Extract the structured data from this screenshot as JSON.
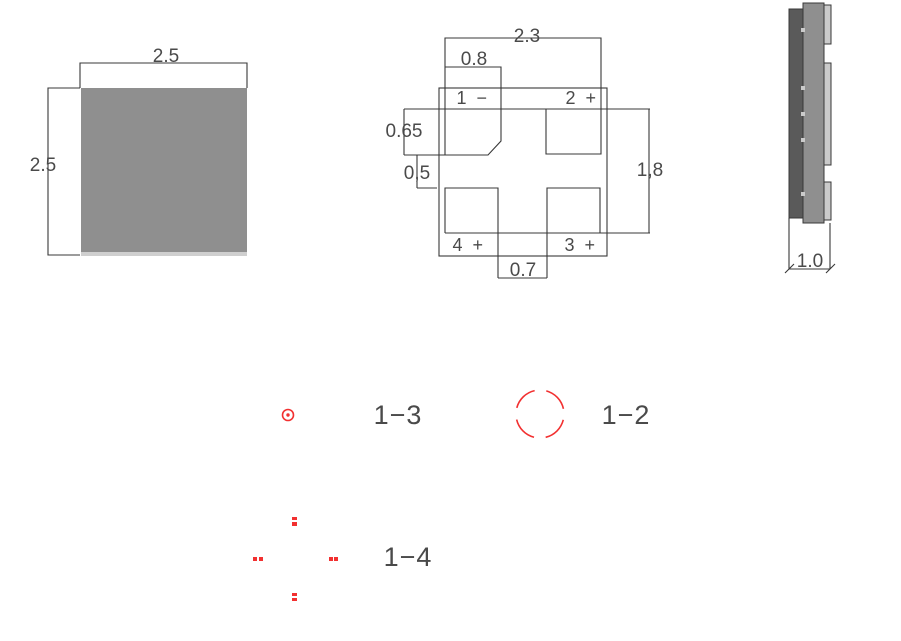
{
  "colors": {
    "line": "#383838",
    "text": "#4a4a4a",
    "red": "#f23030",
    "gray_dark": "#5a5a5a",
    "gray_mid": "#8f8f8f",
    "gray_light": "#cacaca",
    "gray_strip": "#cfcfcf",
    "background": "#ffffff"
  },
  "top_view": {
    "width_dim": "2.5",
    "height_dim": "2.5"
  },
  "pad_view": {
    "overall_width_dim": "2.3",
    "pad_width_dim": "0.8",
    "pad_height_dim": "0.65",
    "slot_height_dim": "0,5",
    "pad_span_dim": "1,8",
    "slot_width_dim": "0.7",
    "pad1_label": "1 −",
    "pad2_label": "2 +",
    "pad3_label": "3 +",
    "pad4_label": "4 +"
  },
  "side_view": {
    "thickness_dim": "1.0"
  },
  "legend": {
    "pair_1_3": "1−3",
    "pair_1_2": "1−2",
    "pair_1_4": "1−4"
  }
}
